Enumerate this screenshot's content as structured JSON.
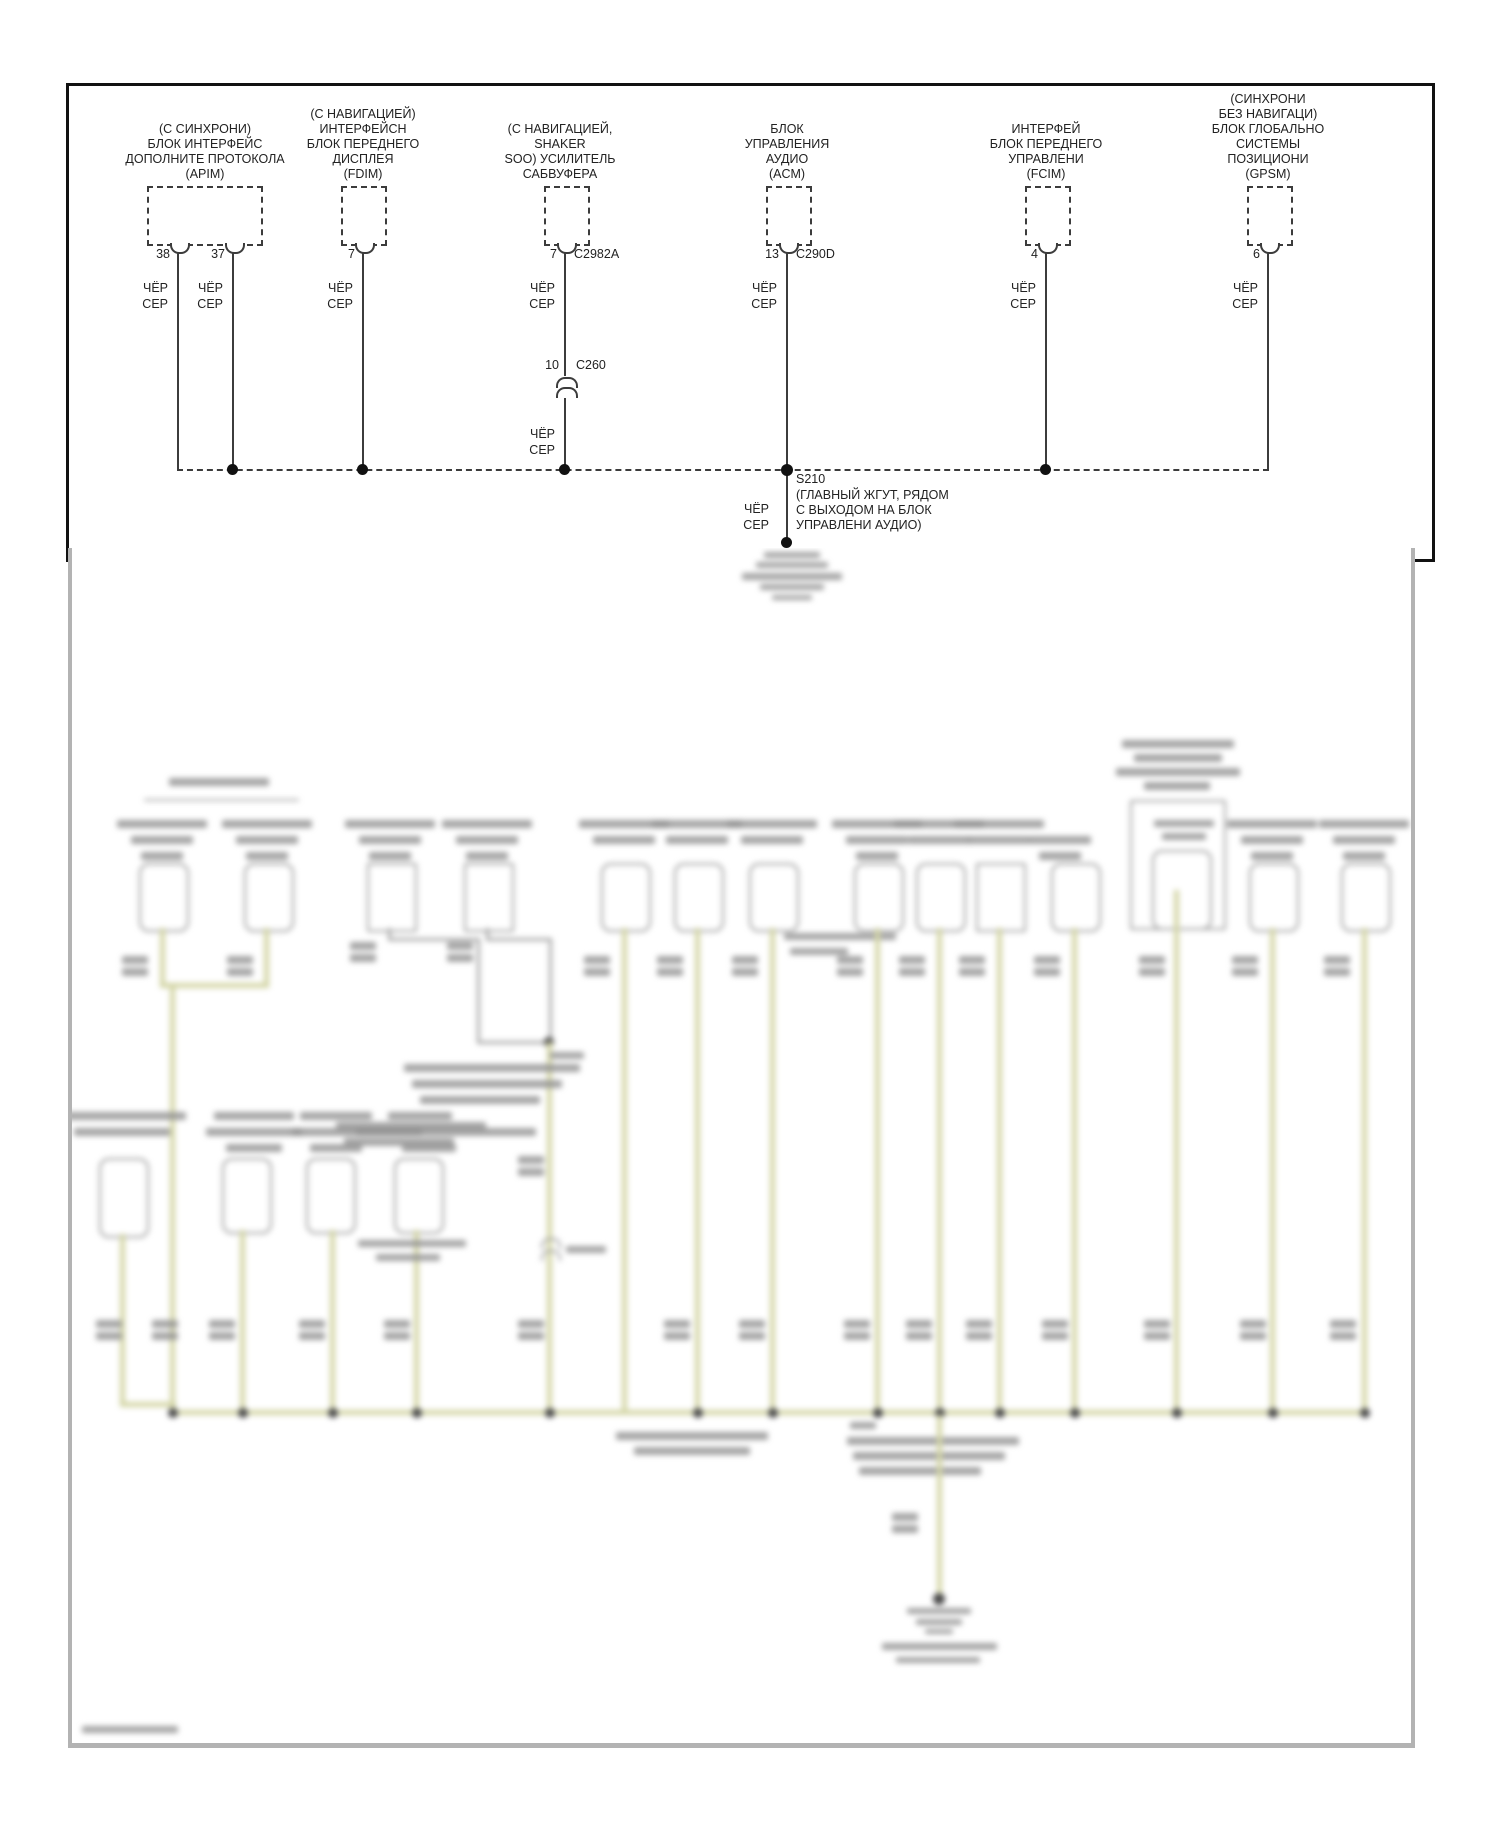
{
  "diagram": {
    "wire_color_label": "ЧЁР\nСЕР",
    "components": [
      {
        "id": "apim",
        "label": "(С СИНХРОНИ)\nБЛОК ИНТЕРФЕЙС\nДОПОЛНИТЕ ПРОТОКОЛА\n(APIM)",
        "pins": [
          "38",
          "37"
        ]
      },
      {
        "id": "fdim",
        "label": "(С НАВИГАЦИЕЙ)\nИНТЕРФЕЙСН\nБЛОК ПЕРЕДНЕГО\nДИСПЛЕЯ\n(FDIM)",
        "pins": [
          "7"
        ]
      },
      {
        "id": "shaker-amp",
        "label": "(С НАВИГАЦИЕЙ,\nSHAKER\nSOO) УСИЛИТЕЛЬ\nСАБВУФЕРА",
        "pins": [
          "7"
        ],
        "connector": "C2982A"
      },
      {
        "id": "acm",
        "label": "БЛОК\nУПРАВЛЕНИЯ\nАУДИО\n(ACM)",
        "pins": [
          "13"
        ],
        "connector": "C290D"
      },
      {
        "id": "fcim",
        "label": "ИНТЕРФЕЙ\nБЛОК ПЕРЕДНЕГО\nУПРАВЛЕНИ\n(FCIM)",
        "pins": [
          "4"
        ]
      },
      {
        "id": "gpsm",
        "label": "(СИНХРОНИ\nБЕЗ НАВИГАЦИ)\nБЛОК ГЛОБАЛЬНО\nСИСТЕМЫ\nПОЗИЦИОНИ\n(GPSM)",
        "pins": [
          "6"
        ]
      }
    ],
    "inline_connector": {
      "pin": "10",
      "name": "C260"
    },
    "splice": {
      "id": "S210",
      "note": "(ГЛАВНЫЙ ЖГУТ, РЯДОМ\nС ВЫХОДОМ НА БЛОК\nУПРАВЛЕНИ АУДИО)"
    }
  },
  "blurred_section": {
    "legible": false
  }
}
